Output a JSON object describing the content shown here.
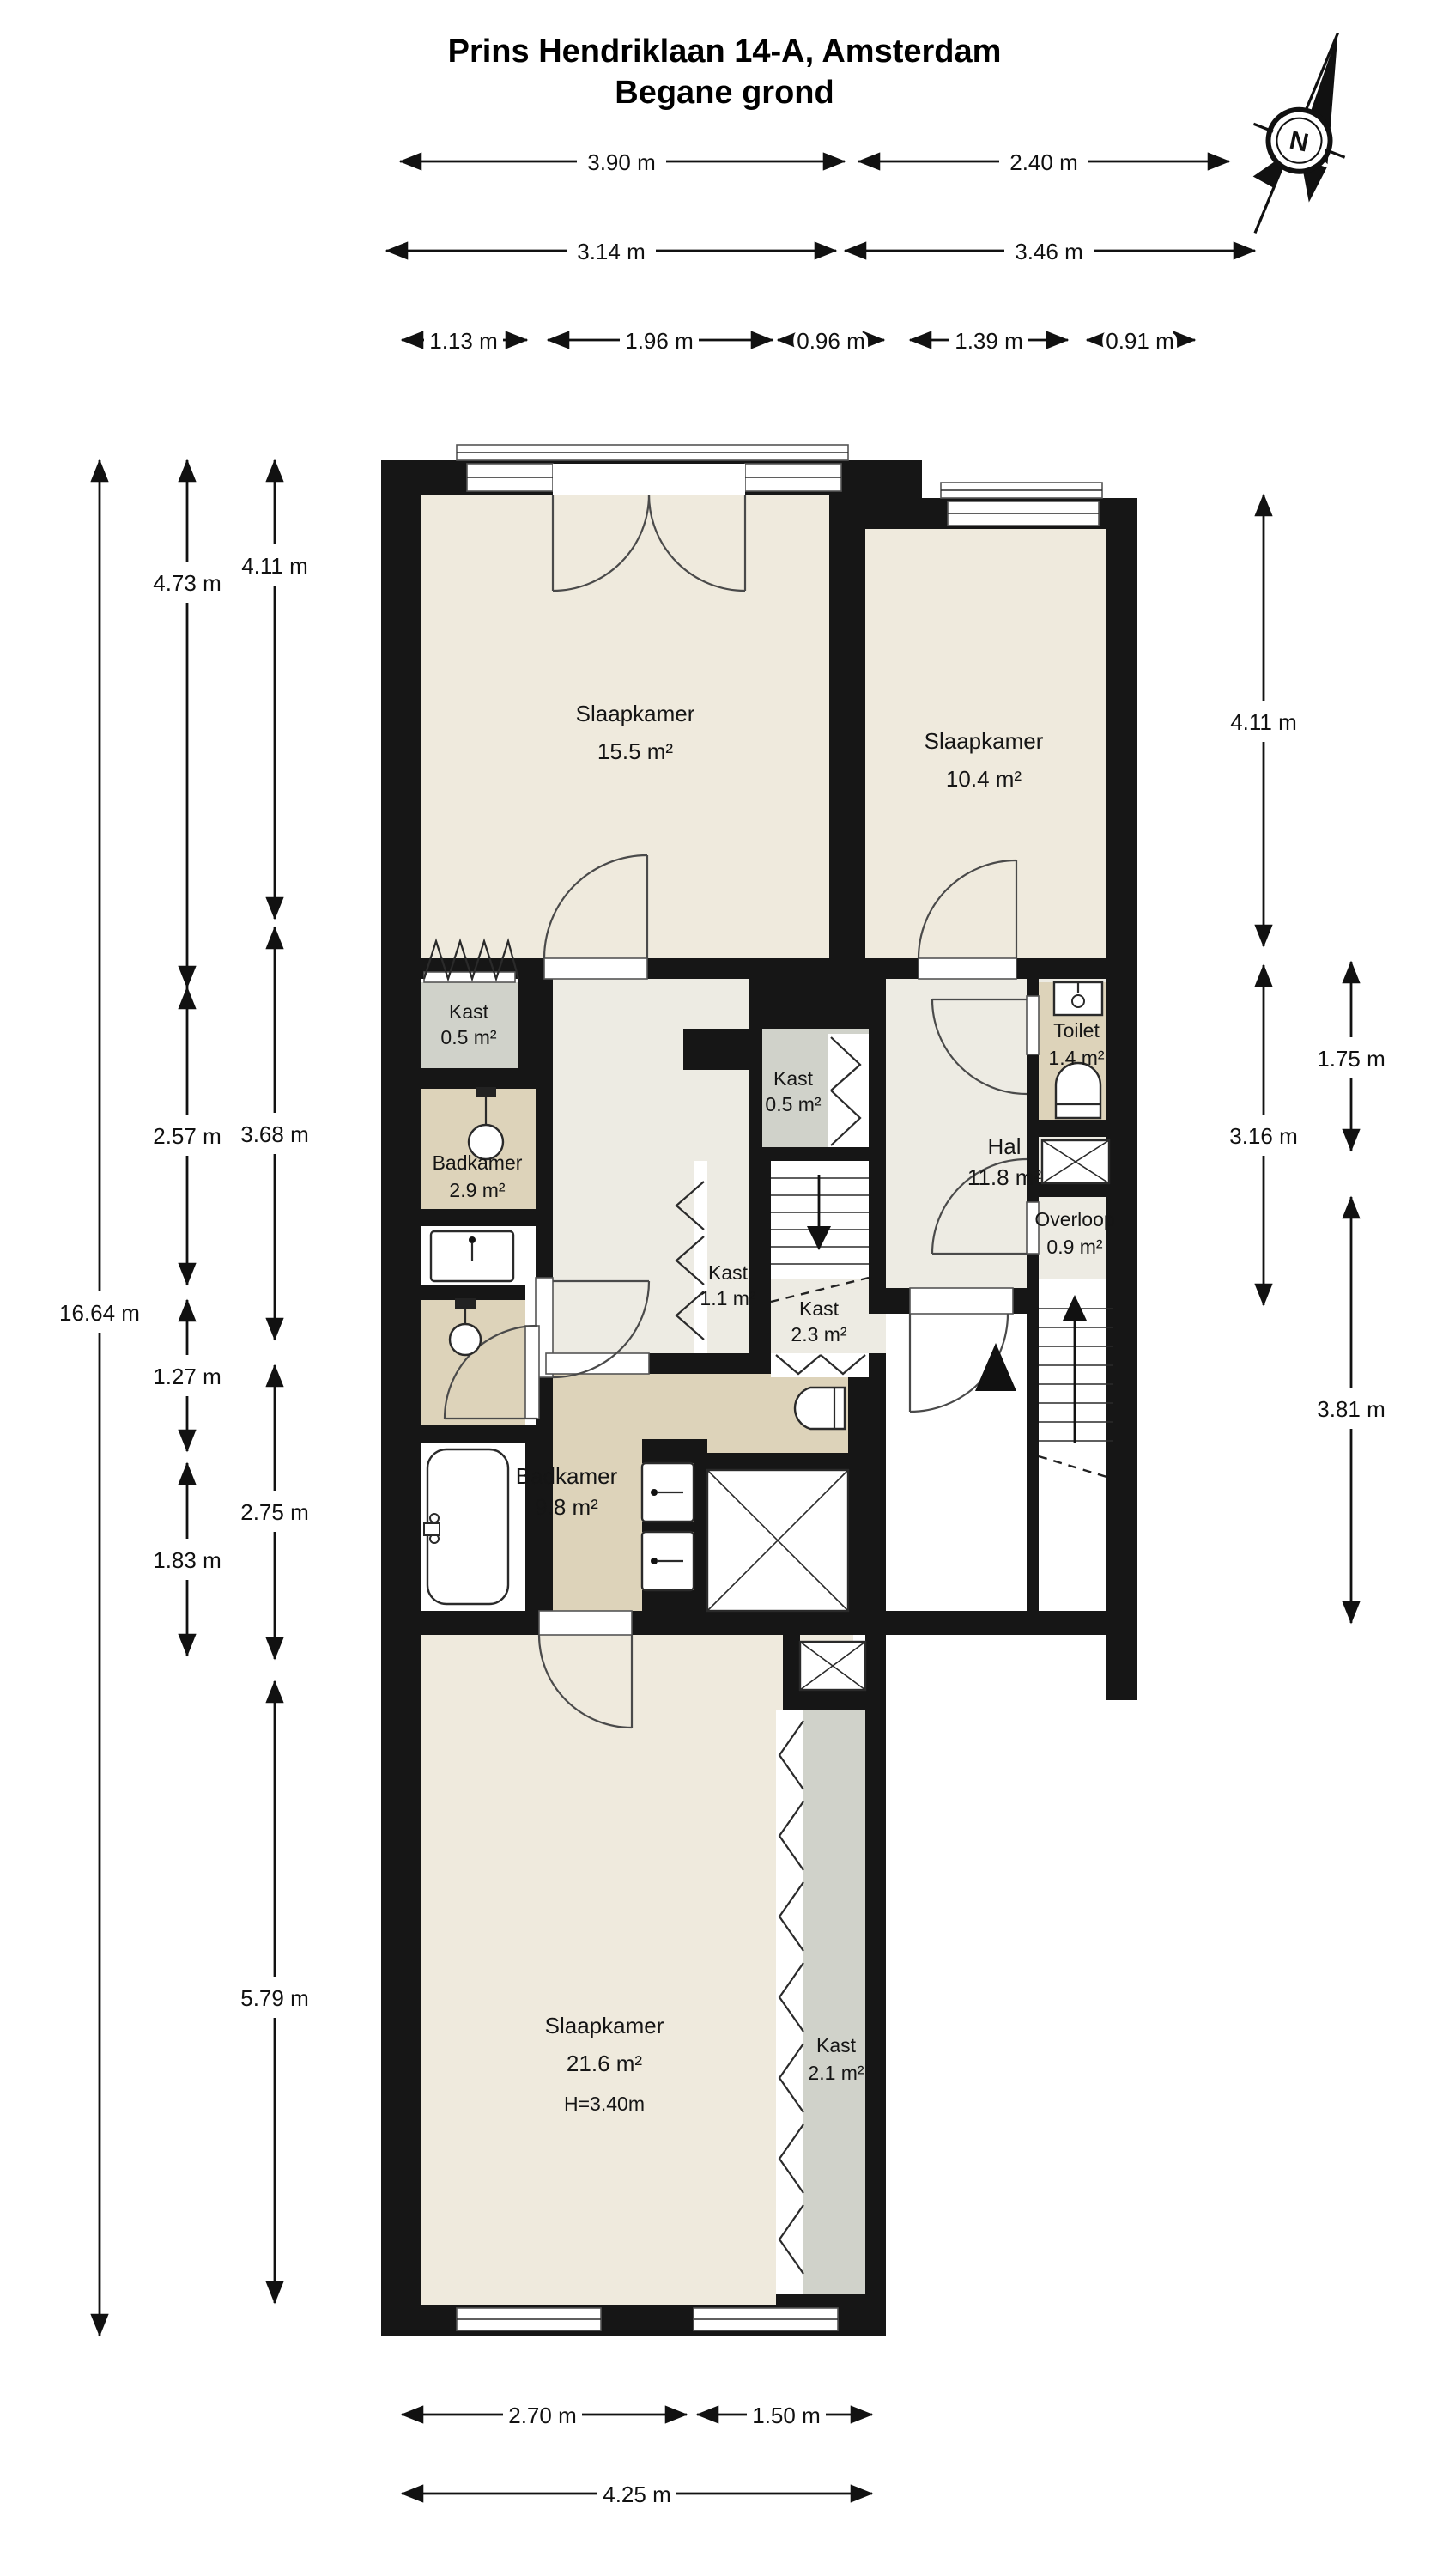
{
  "title": {
    "line1": "Prins Hendriklaan 14-A, Amsterdam",
    "line2": "Begane grond"
  },
  "compass": {
    "label": "N"
  },
  "rooms": [
    {
      "name": "Slaapkamer",
      "area": "15.5 m²"
    },
    {
      "name": "Slaapkamer",
      "area": "10.4 m²"
    },
    {
      "name": "Kast",
      "area": "0.5 m²"
    },
    {
      "name": "Kast",
      "area": "0.5 m²"
    },
    {
      "name": "Badkamer",
      "area": "2.9 m²"
    },
    {
      "name": "Hal",
      "area": "11.8 m²"
    },
    {
      "name": "Toilet",
      "area": "1.4 m²"
    },
    {
      "name": "Kast",
      "area": "1.1 m²"
    },
    {
      "name": "Kast",
      "area": "2.3 m²"
    },
    {
      "name": "Overloop",
      "area": "0.9 m²"
    },
    {
      "name": "Badkamer",
      "area": "9.8 m²"
    },
    {
      "name": "Slaapkamer",
      "area": "21.6 m²",
      "height": "H=3.40m"
    },
    {
      "name": "Kast",
      "area": "2.1 m²"
    }
  ],
  "dimensions": {
    "top_row1": [
      "3.90 m",
      "2.40 m"
    ],
    "top_row2": [
      "3.14 m",
      "3.46 m"
    ],
    "top_row3": [
      "1.13 m",
      "1.96 m",
      "0.96 m",
      "1.39 m",
      "0.91 m"
    ],
    "left_total": "16.64 m",
    "left_col_inner": [
      "4.73 m",
      "2.57 m",
      "1.27 m",
      "1.83 m"
    ],
    "left_col_mid": [
      "4.11 m",
      "3.68 m",
      "2.75 m",
      "5.79 m"
    ],
    "right_col_inner": [
      "4.11 m",
      "3.16 m"
    ],
    "right_col_outer": [
      "1.75 m",
      "3.81 m"
    ],
    "bottom_row1": [
      "2.70 m",
      "1.50 m"
    ],
    "bottom_row2": [
      "4.25 m"
    ]
  }
}
